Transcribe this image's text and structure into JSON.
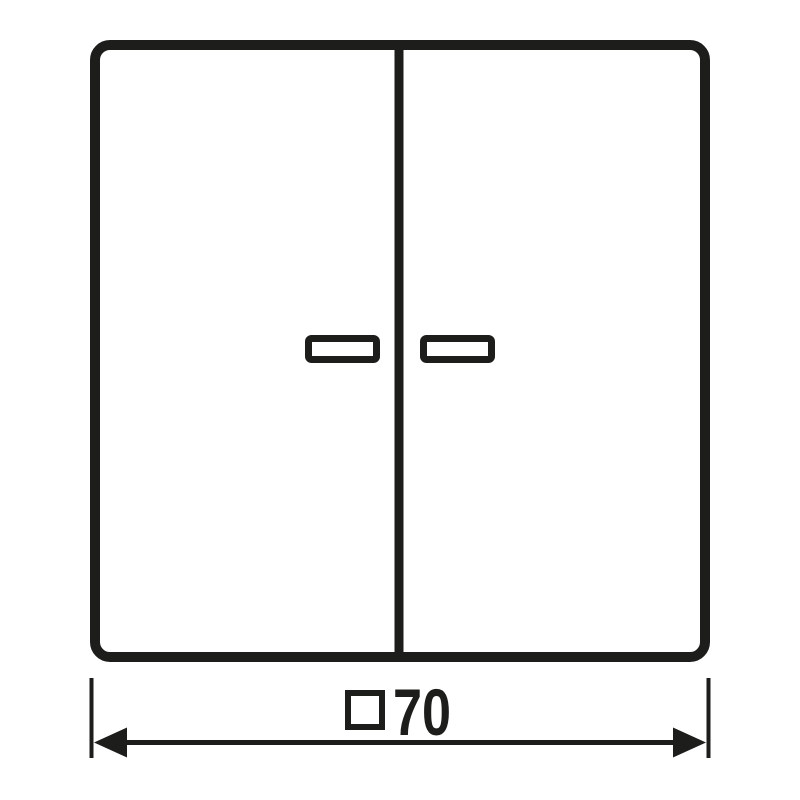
{
  "drawing": {
    "type": "technical-dimension-drawing",
    "subject": "two-gang-rocker-switch-front-view",
    "background_color": "#ffffff",
    "stroke_color": "#1d1d1b",
    "elements": {
      "switch_outline": "rounded-square-cover-plate",
      "rocker_divider": "vertical-center-line",
      "left_indicator_window": "small-rectangle",
      "right_indicator_window": "small-rectangle"
    },
    "dimension": {
      "label": "□70",
      "symbol": "□",
      "value": "70",
      "meaning": "square 70"
    }
  }
}
